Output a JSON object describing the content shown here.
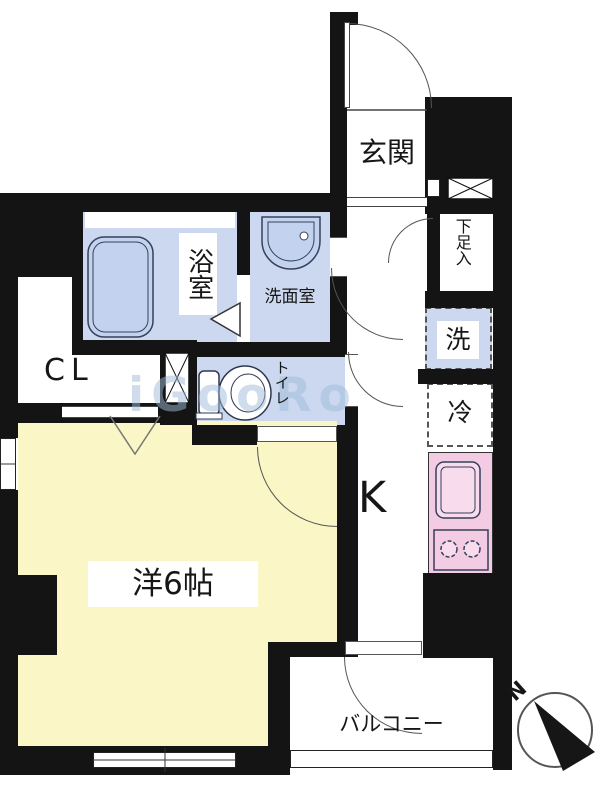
{
  "colors": {
    "wall": "#141414",
    "room_yellow": "#FAF6C6",
    "wet_blue": "#CBD8F0",
    "fixture_blue": "#C3D2EE",
    "kitchen_pink": "#F3CBE3",
    "kitchen_fixture": "#F8DCEE",
    "watermark": "#9FBBD8"
  },
  "rooms": {
    "genkan": {
      "label": "玄関"
    },
    "bath": {
      "label": "浴室"
    },
    "washroom": {
      "label": "洗面室"
    },
    "toilet": {
      "label": "トイレ"
    },
    "closet": {
      "label": "CL"
    },
    "shoe_cabinet": {
      "label": "下足入"
    },
    "washer": {
      "label": "洗"
    },
    "fridge": {
      "label": "冷"
    },
    "kitchen": {
      "label": "K"
    },
    "main_room": {
      "label": "洋6帖"
    },
    "balcony": {
      "label": "バルコニー"
    }
  },
  "compass": {
    "north_label": "N"
  },
  "watermark": {
    "text": "iGooRo"
  }
}
